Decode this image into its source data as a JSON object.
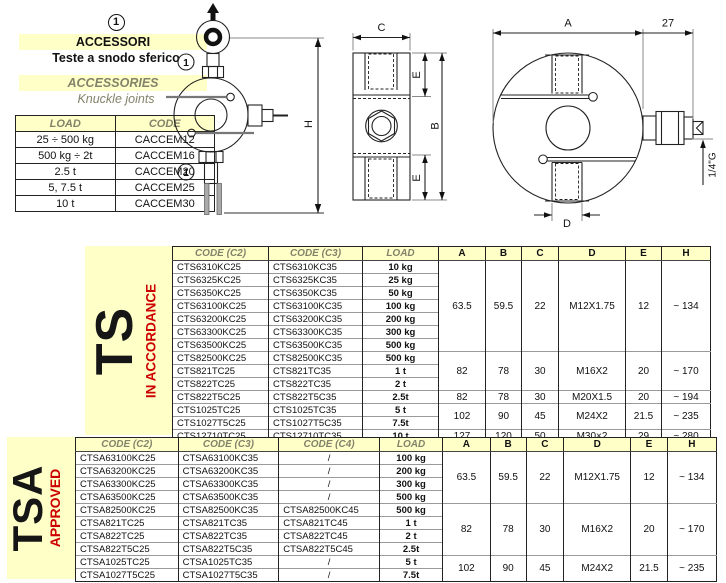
{
  "colors": {
    "accent_yellow": "#FFFFC8",
    "status_red": "#CC0000",
    "header_text": "#83836A"
  },
  "accessories_panel": {
    "ref_mark": "1",
    "title_it": "ACCESSORI",
    "subtitle_it": "Teste a snodo sferico",
    "title_en": "ACCESSORIES",
    "subtitle_en": "Knuckle joints",
    "table": {
      "headers": [
        "LOAD",
        "CODE"
      ],
      "rows": [
        [
          "25 ÷ 500 kg",
          "CACCEM12"
        ],
        [
          "500 kg ÷ 2t",
          "CACCEM16"
        ],
        [
          "2.5 t",
          "CACCEM20"
        ],
        [
          "5, 7.5 t",
          "CACCEM25"
        ],
        [
          "10 t",
          "CACCEM30"
        ]
      ]
    }
  },
  "drawings": {
    "ref_mark": "1",
    "labels": {
      "h": "H",
      "c": "C",
      "e": "E",
      "b": "B",
      "a": "A",
      "d": "D",
      "offset": "27",
      "thread": "1/4\"G"
    }
  },
  "ts_table": {
    "series_label": "TS",
    "status_label": "IN ACCORDANCE",
    "headers": [
      "CODE (C2)",
      "CODE (C3)",
      "LOAD",
      "A",
      "B",
      "C",
      "D",
      "E",
      "H"
    ],
    "rows": [
      {
        "c2": "CTS6310KC25",
        "c3": "CTS6310KC35",
        "load": "10 kg",
        "dims": {
          "span": 7,
          "a": "63.5",
          "b": "59.5",
          "c": "22",
          "d": "M12X1.75",
          "e": "12",
          "h": "~ 134"
        }
      },
      {
        "c2": "CTS6325KC25",
        "c3": "CTS6325KC35",
        "load": "25 kg"
      },
      {
        "c2": "CTS6350KC25",
        "c3": "CTS6350KC35",
        "load": "50 kg"
      },
      {
        "c2": "CTS63100KC25",
        "c3": "CTS63100KC35",
        "load": "100 kg"
      },
      {
        "c2": "CTS63200KC25",
        "c3": "CTS63200KC35",
        "load": "200 kg"
      },
      {
        "c2": "CTS63300KC25",
        "c3": "CTS63300KC35",
        "load": "300 kg"
      },
      {
        "c2": "CTS63500KC25",
        "c3": "CTS63500KC35",
        "load": "500 kg"
      },
      {
        "c2": "CTS82500KC25",
        "c3": "CTS82500KC35",
        "load": "500 kg",
        "dims": {
          "span": 3,
          "a": "82",
          "b": "78",
          "c": "30",
          "d": "M16X2",
          "e": "20",
          "h": "~ 170"
        }
      },
      {
        "c2": "CTS821TC25",
        "c3": "CTS821TC35",
        "load": "1 t"
      },
      {
        "c2": "CTS822TC25",
        "c3": "CTS822TC35",
        "load": "2 t"
      },
      {
        "c2": "CTS822T5C25",
        "c3": "CTS822T5C35",
        "load": "2.5t",
        "dims": {
          "span": 1,
          "a": "82",
          "b": "78",
          "c": "30",
          "d": "M20X1.5",
          "e": "20",
          "h": "~ 194"
        }
      },
      {
        "c2": "CTS1025TC25",
        "c3": "CTS1025TC35",
        "load": "5 t",
        "dims": {
          "span": 2,
          "a": "102",
          "b": "90",
          "c": "45",
          "d": "M24X2",
          "e": "21.5",
          "h": "~ 235"
        }
      },
      {
        "c2": "CTS1027T5C25",
        "c3": "CTS1027T5C35",
        "load": "7.5t"
      },
      {
        "c2": "CTS12710TC25",
        "c3": "CTS12710TC35",
        "load": "10 t",
        "dims": {
          "span": 1,
          "a": "127",
          "b": "120",
          "c": "50",
          "d": "M30×2",
          "e": "29",
          "h": "~ 280"
        }
      }
    ]
  },
  "tsa_table": {
    "series_label": "TSA",
    "status_label": "APPROVED",
    "headers": [
      "CODE (C2)",
      "CODE (C3)",
      "CODE (C4)",
      "LOAD",
      "A",
      "B",
      "C",
      "D",
      "E",
      "H"
    ],
    "rows": [
      {
        "c2": "CTSA63100KC25",
        "c3": "CTSA63100KC35",
        "c4": "/",
        "load": "100 kg",
        "dims": {
          "span": 4,
          "a": "63.5",
          "b": "59.5",
          "c": "22",
          "d": "M12X1.75",
          "e": "12",
          "h": "~ 134"
        }
      },
      {
        "c2": "CTSA63200KC25",
        "c3": "CTSA63200KC35",
        "c4": "/",
        "load": "200 kg"
      },
      {
        "c2": "CTSA63300KC25",
        "c3": "CTSA63300KC35",
        "c4": "/",
        "load": "300 kg"
      },
      {
        "c2": "CTSA63500KC25",
        "c3": "CTSA63500KC35",
        "c4": "/",
        "load": "500 kg"
      },
      {
        "c2": "CTSA82500KC25",
        "c3": "CTSA82500KC35",
        "c4": "CTSA82500KC45",
        "load": "500 kg",
        "dims": {
          "span": 4,
          "a": "82",
          "b": "78",
          "c": "30",
          "d": "M16X2",
          "e": "20",
          "h": "~ 170"
        }
      },
      {
        "c2": "CTSA821TC25",
        "c3": "CTSA821TC35",
        "c4": "CTSA821TC45",
        "load": "1 t"
      },
      {
        "c2": "CTSA822TC25",
        "c3": "CTSA822TC35",
        "c4": "CTSA822TC45",
        "load": "2 t"
      },
      {
        "c2": "CTSA822T5C25",
        "c3": "CTSA822T5C35",
        "c4": "CTSA822T5C45",
        "load": "2.5t"
      },
      {
        "c2": "CTSA1025TC25",
        "c3": "CTSA1025TC35",
        "c4": "/",
        "load": "5 t",
        "dims": {
          "span": 2,
          "a": "102",
          "b": "90",
          "c": "45",
          "d": "M24X2",
          "e": "21.5",
          "h": "~ 235"
        }
      },
      {
        "c2": "CTSA1027T5C25",
        "c3": "CTSA1027T5C35",
        "c4": "/",
        "load": "7.5t"
      }
    ]
  }
}
